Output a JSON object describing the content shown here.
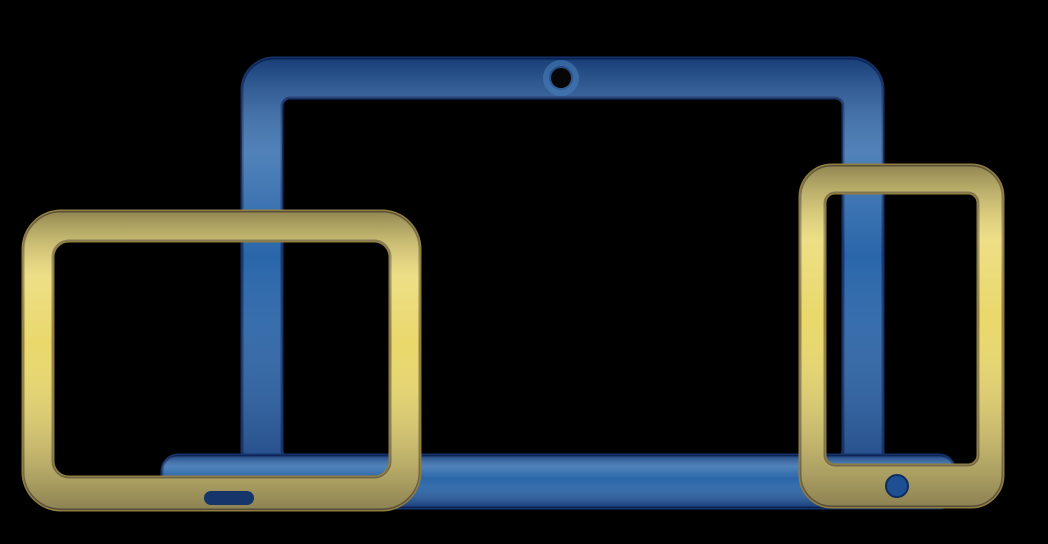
{
  "illustration": {
    "name": "responsive-devices-icon",
    "devices": [
      {
        "name": "laptop-icon"
      },
      {
        "name": "tablet-icon"
      },
      {
        "name": "smartphone-icon"
      }
    ]
  },
  "colors": {
    "background": "#000000",
    "laptop_blue": "#2563a8",
    "laptop_edge_navy": "#13336b",
    "device_yellow": "#e9d768",
    "device_edge_gold": "#8f7e40",
    "webcam_black": "#060606",
    "webcam_halo_blue": "#4a7fbc",
    "home_button_blue": "#1d4f92",
    "home_slot_navy": "#16356b"
  }
}
